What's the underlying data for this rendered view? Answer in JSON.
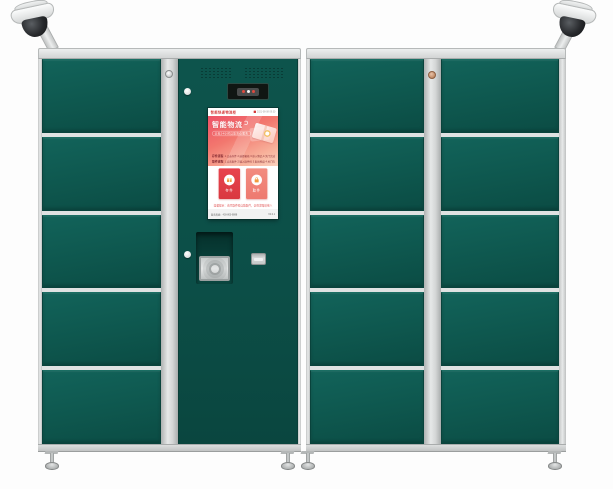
{
  "layout": {
    "cabinets": [
      {
        "id": "left",
        "door_rows": 5,
        "door_columns": 1,
        "has_control_panel": true
      },
      {
        "id": "right",
        "door_rows": 5,
        "door_columns": 2,
        "has_control_panel": false
      }
    ],
    "cameras": [
      {
        "position": "top-left",
        "name": "cctv-dome-camera"
      },
      {
        "position": "top-right",
        "name": "cctv-dome-camera"
      }
    ]
  },
  "colors": {
    "door_green": "#0e574e",
    "panel_green": "#0c4f47",
    "frame_gray": "#d8dada",
    "screen_accent_red": "#e8434d",
    "banner_gradient_start": "#ed5066",
    "banner_gradient_end": "#fbd2bf"
  },
  "kiosk": {
    "devices": {
      "camera_window": "face-camera-window",
      "speaker": "speaker-grille",
      "scanner": "barcode-scanner-window",
      "card_slot": "ic-card-slot",
      "panel_locks": "key-lock"
    },
    "screen": {
      "header": {
        "brand": "智能快递物流柜",
        "datetime": "2021-08-08 09:30"
      },
      "banner": {
        "title": "智能物流",
        "badge": "全天24小时自助寄存服务"
      },
      "steps": [
        {
          "label": "存件流程",
          "text": "1.点击存件 2.选择箱格 3.放入物品 4.关门完成"
        },
        {
          "label": "取件流程",
          "text": "1.点击取件 2.输入取件码 3.取出物品 4.关门完成"
        }
      ],
      "actions": [
        {
          "label": "存件",
          "icon": "deposit-box-icon"
        },
        {
          "label": "取件",
          "icon": "pickup-lock-icon"
        }
      ],
      "tip": "温馨提示：请凭取件码自助取件，切勿泄露给他人",
      "footer_left": "服务热线：400-800-8888",
      "footer_right": "V2.0.1"
    }
  }
}
